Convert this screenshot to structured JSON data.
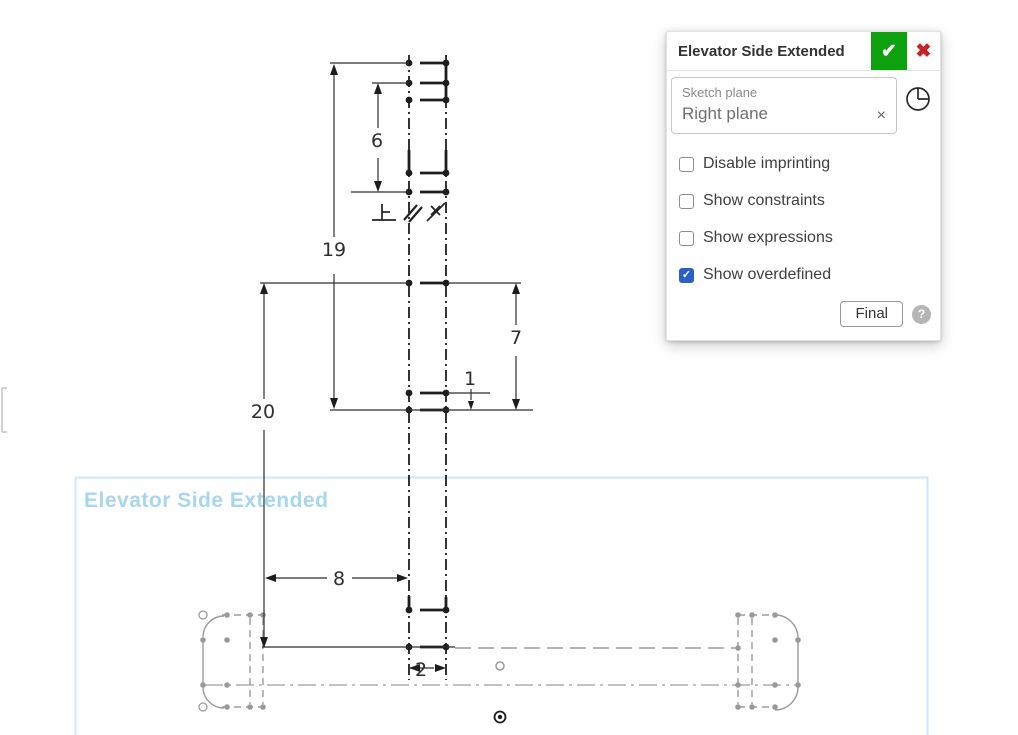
{
  "dialog": {
    "title": "Elevator Side Extended",
    "confirm_glyph": "✔",
    "cancel_glyph": "✖",
    "sketch_plane": {
      "label": "Sketch plane",
      "value": "Right plane",
      "clear_glyph": "×"
    },
    "checkboxes": [
      {
        "label": "Disable imprinting",
        "checked": false
      },
      {
        "label": "Show constraints",
        "checked": false
      },
      {
        "label": "Show expressions",
        "checked": false
      },
      {
        "label": "Show overdefined",
        "checked": true
      }
    ],
    "check_glyph": "✓",
    "final_button": "Final",
    "help_glyph": "?"
  },
  "canvas": {
    "sketch_label": "Elevator Side Extended",
    "dimensions": {
      "d6": "6",
      "d19": "19",
      "d20": "20",
      "d7": "7",
      "d1": "1",
      "d8": "8",
      "d2": "2"
    },
    "constraint_icons": [
      "perpendicular-icon",
      "parallel-icon",
      "pierce-icon"
    ],
    "origin_icon": "origin-icon"
  },
  "colors": {
    "confirm_green": "#0da10f",
    "cancel_red": "#c3242a",
    "checkbox_blue": "#2a5fc7",
    "sketch_label_blue": "#a8d5f0",
    "sketch_box_blue": "#cfe7f6",
    "geometry_dark": "#1d1d1d",
    "geometry_gray": "#9b9b9b"
  }
}
